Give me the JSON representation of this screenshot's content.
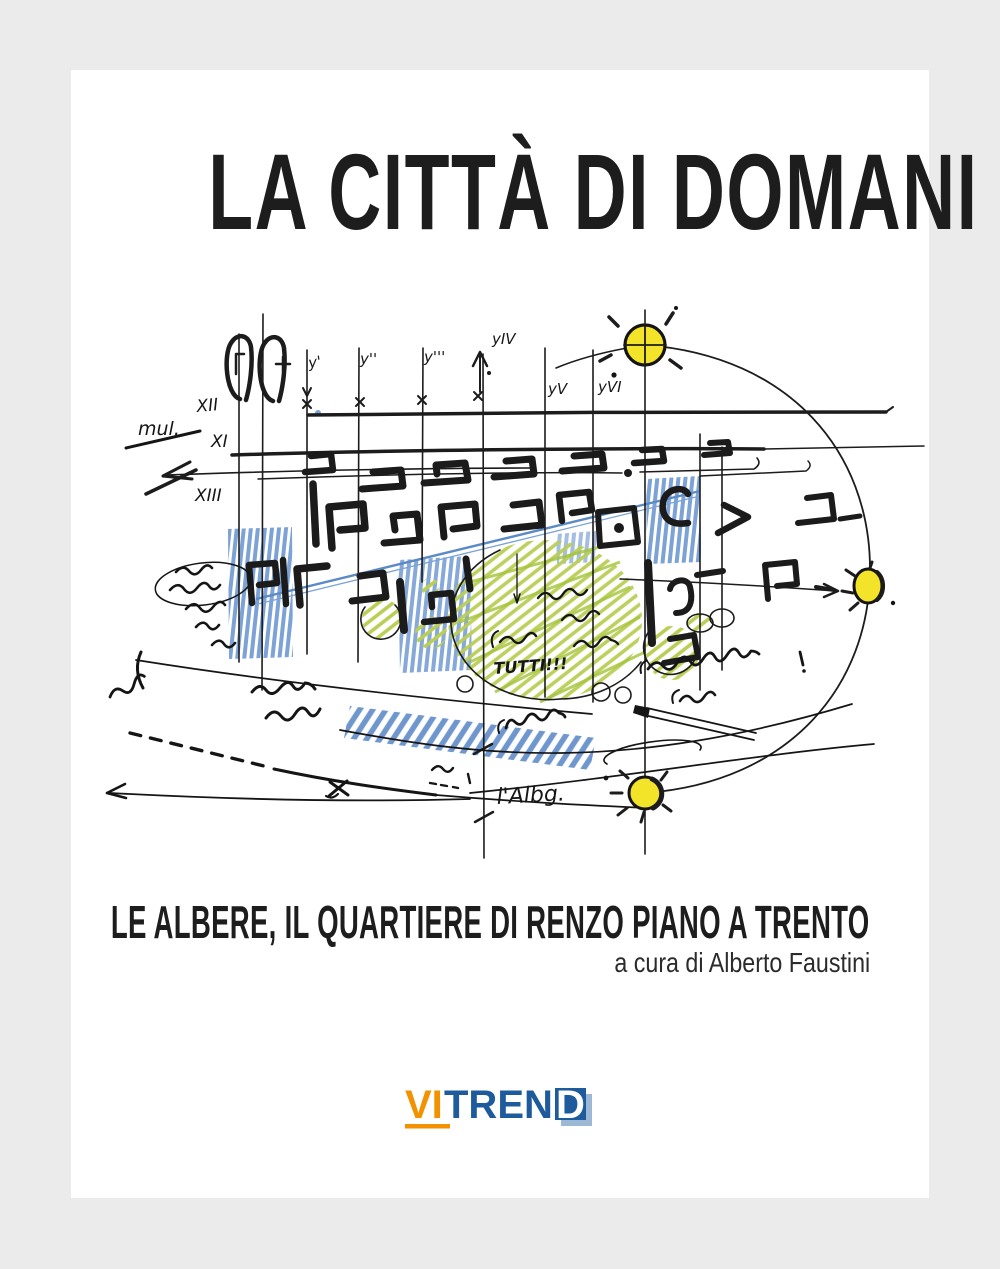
{
  "page": {
    "background": "#ebebeb",
    "cover_background": "#ffffff"
  },
  "cover": {
    "title": "LA CITTÀ DI DOMANI",
    "subtitle": "LE ALBERE, IL QUARTIERE DI RENZO PIANO A TRENTO",
    "byline": "a cura di Alberto Faustini"
  },
  "publisher": {
    "name": "VITREND",
    "part_vi": "VI",
    "part_tren": "TREN",
    "part_d": "D",
    "orange": "#f39200",
    "blue": "#1e5b9c",
    "lightblue": "#9cb8d5"
  },
  "sketch": {
    "description": "hand-drawn architectural masterplan sketch in ink with blue, green and yellow pencil",
    "ink_color": "#1c1c1c",
    "pencil_blue": "#6f97cd",
    "pencil_green": "#aecb4a",
    "sun_yellow": "#f3e329",
    "axis_labels_x": [
      "XII",
      "XI",
      "XIII"
    ],
    "axis_labels_y": [
      "y'",
      "y''",
      "y'''",
      "yIV",
      "yV",
      "yVI"
    ],
    "notes": [
      "mul.",
      "TUTTI!!!",
      "l'Albg."
    ]
  }
}
